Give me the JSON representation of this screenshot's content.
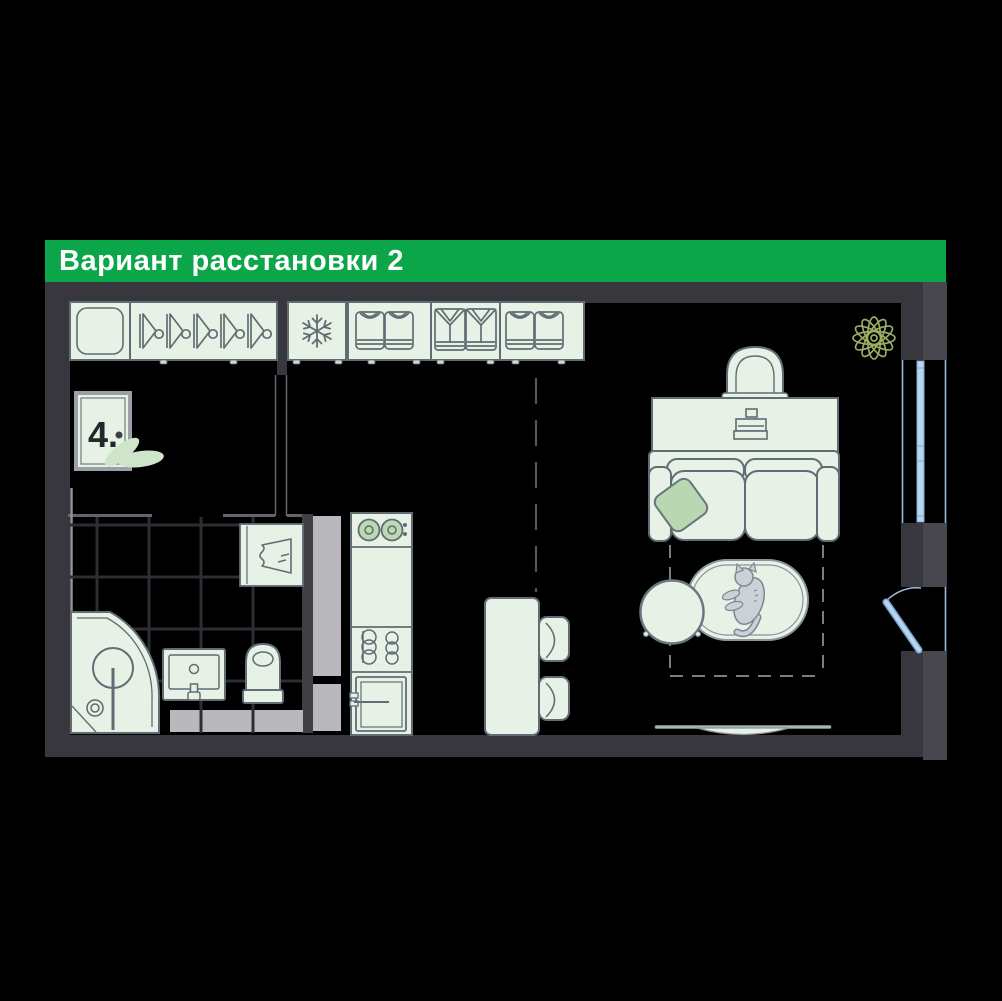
{
  "header": {
    "title": "Вариант расстановки 2",
    "background_color": "#0ca64a",
    "text_color": "#ffffff"
  },
  "floor_plan": {
    "door_plate_label": "4.",
    "colors": {
      "wall_dark": "#37373d",
      "wall_outer": "#47474d",
      "floor": "#000000",
      "furniture_fill": "#e7f1e5",
      "furniture_outline": "#5f6d74",
      "accent_green": "#b9d8b2",
      "leaf_green": "#cfe5ca",
      "window_blue": "#b8d4ee",
      "window_edge_blue": "#7da7d0",
      "light_gray_block": "#b9b9bd",
      "plant_olive": "#9aad62",
      "cat_gray": "#ccd1d7",
      "tile_line": "#2d2d33"
    },
    "rooms": [
      "hallway",
      "bathroom",
      "kitchen",
      "living-room"
    ],
    "furniture": [
      "wardrobe-shelf-box",
      "wardrobe-hangers",
      "refrigerator",
      "closet-folded-tshirts",
      "closet-folded-shirts",
      "entrance-door-plate",
      "corner-shower",
      "washbasin",
      "toilet",
      "towel-cabinet",
      "cooktop",
      "kitchen-counter",
      "washing-machine",
      "dining-table",
      "dining-chairs",
      "desk",
      "desk-chair",
      "laptop",
      "sofa",
      "pillow",
      "coffee-table",
      "rug",
      "cat",
      "tv",
      "house-plant",
      "window",
      "balcony-door"
    ],
    "icons": [
      "hanger-icon",
      "snowflake-icon",
      "tshirt-icon",
      "shirt-icon",
      "towel-icon",
      "shower-head-icon",
      "drain-icon",
      "faucet-icon",
      "burner-icon",
      "washer-door-icon",
      "laptop-icon",
      "cat-icon",
      "plant-icon",
      "tv-icon",
      "window-glass-icon",
      "door-swing-icon"
    ]
  }
}
